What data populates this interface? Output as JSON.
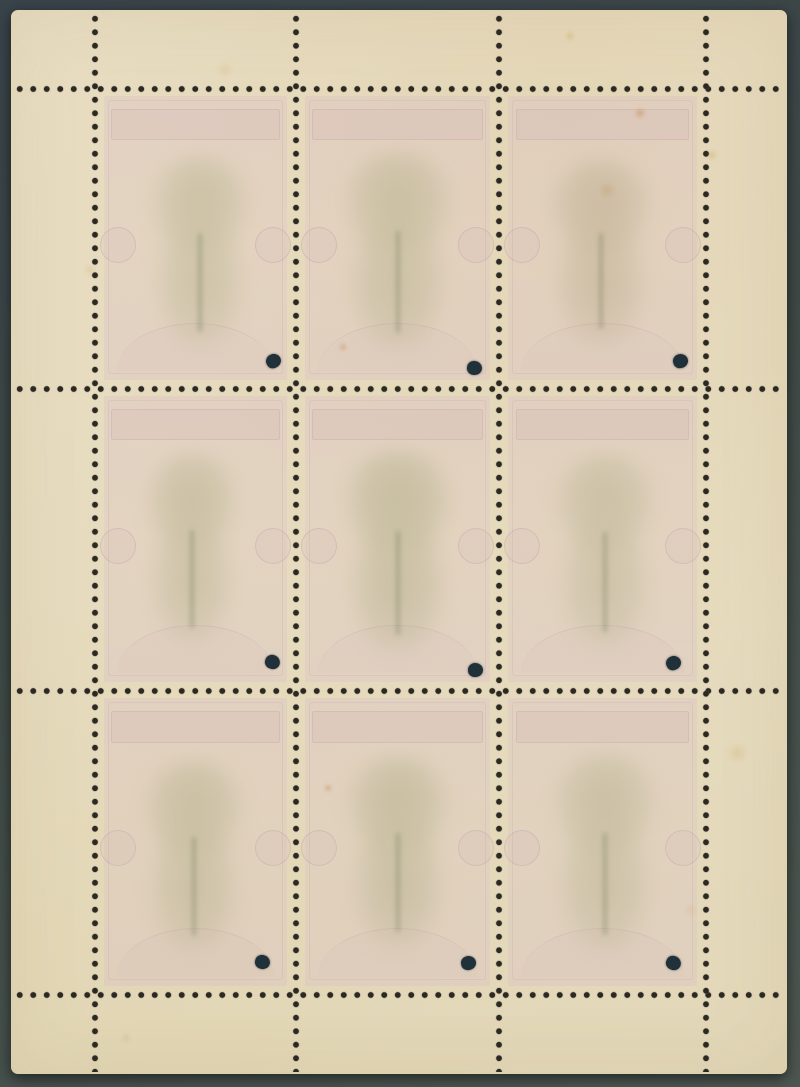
{
  "scene": {
    "description": "Photograph of the reverse (gum side) of a mint 3x3 stamp sheetlet with full perforation grid, one black punch hole per stamp, and faint show-through of a tree-design stamp printed in green and rose",
    "background": {
      "top_color": "#39434a",
      "bottom_color": "#4d5751"
    },
    "sheet": {
      "x": 11,
      "y": 10,
      "width": 776,
      "height": 1064,
      "paper_color": "#e7dcc0",
      "corner_radius": 7
    }
  },
  "perforations": {
    "dot_color": "#2b2922",
    "halo_color": "#6b6152",
    "dot_diameter": 6,
    "dot_spacing": 13.5,
    "h_lines_y": [
      79,
      379,
      681,
      985
    ],
    "v_lines_x": [
      84,
      285,
      488,
      695
    ]
  },
  "punch_hole": {
    "color": "#20313a",
    "diameter": 15
  },
  "stamp_design": {
    "pink_tint": "#d9bec6",
    "ornament_color": "#c29cae",
    "trunk_color": "#83886b"
  },
  "stamps": [
    {
      "x": 84,
      "y": 79,
      "w": 201,
      "h": 300,
      "dot": {
        "x": 178,
        "y": 272
      },
      "blob": {
        "top": 68,
        "h": 190,
        "w": 108,
        "dx": 4,
        "tint": "#b4b089",
        "opacity": 0.52
      }
    },
    {
      "x": 285,
      "y": 79,
      "w": 203,
      "h": 300,
      "dot": {
        "x": 178,
        "y": 279
      },
      "blob": {
        "top": 64,
        "h": 196,
        "w": 118,
        "dx": 0,
        "tint": "#b2ae88",
        "opacity": 0.55
      }
    },
    {
      "x": 488,
      "y": 79,
      "w": 207,
      "h": 300,
      "dot": {
        "x": 181,
        "y": 272
      },
      "blob": {
        "top": 70,
        "h": 185,
        "w": 112,
        "dx": -2,
        "tint": "#b3a584",
        "opacity": 0.5
      }
    },
    {
      "x": 84,
      "y": 379,
      "w": 201,
      "h": 302,
      "dot": {
        "x": 177,
        "y": 273
      },
      "blob": {
        "top": 66,
        "h": 188,
        "w": 100,
        "dx": -4,
        "tint": "#b1ad86",
        "opacity": 0.52
      }
    },
    {
      "x": 285,
      "y": 379,
      "w": 203,
      "h": 302,
      "dot": {
        "x": 179,
        "y": 281
      },
      "blob": {
        "top": 62,
        "h": 200,
        "w": 118,
        "dx": 0,
        "tint": "#aeab84",
        "opacity": 0.56
      }
    },
    {
      "x": 488,
      "y": 379,
      "w": 207,
      "h": 302,
      "dot": {
        "x": 174,
        "y": 274
      },
      "blob": {
        "top": 66,
        "h": 192,
        "w": 110,
        "dx": 2,
        "tint": "#b2ae88",
        "opacity": 0.5
      }
    },
    {
      "x": 84,
      "y": 681,
      "w": 201,
      "h": 304,
      "dot": {
        "x": 167,
        "y": 271
      },
      "blob": {
        "top": 70,
        "h": 190,
        "w": 108,
        "dx": -2,
        "tint": "#b0ac86",
        "opacity": 0.52
      }
    },
    {
      "x": 285,
      "y": 681,
      "w": 203,
      "h": 304,
      "dot": {
        "x": 172,
        "y": 272
      },
      "blob": {
        "top": 66,
        "h": 190,
        "w": 112,
        "dx": 0,
        "tint": "#afab85",
        "opacity": 0.54
      }
    },
    {
      "x": 488,
      "y": 681,
      "w": 207,
      "h": 304,
      "dot": {
        "x": 174,
        "y": 272
      },
      "blob": {
        "top": 64,
        "h": 196,
        "w": 114,
        "dx": 2,
        "tint": "#b1ad87",
        "opacity": 0.5
      }
    }
  ],
  "foxing_spots": [
    {
      "x": 629,
      "y": 103,
      "r": 6,
      "opacity": 0.45,
      "color": "#c07830"
    },
    {
      "x": 596,
      "y": 180,
      "r": 8,
      "opacity": 0.28,
      "color": "#c08a40"
    },
    {
      "x": 559,
      "y": 26,
      "r": 5,
      "opacity": 0.35,
      "color": "#c8922f"
    },
    {
      "x": 701,
      "y": 145,
      "r": 6,
      "opacity": 0.3,
      "color": "#c49038"
    },
    {
      "x": 332,
      "y": 337,
      "r": 4,
      "opacity": 0.45,
      "color": "#bd7226"
    },
    {
      "x": 317,
      "y": 778,
      "r": 4,
      "opacity": 0.5,
      "color": "#bd7226"
    },
    {
      "x": 726,
      "y": 743,
      "r": 11,
      "opacity": 0.22,
      "color": "#c89d4e"
    },
    {
      "x": 79,
      "y": 260,
      "r": 6,
      "opacity": 0.18,
      "color": "#b98c45"
    },
    {
      "x": 115,
      "y": 1028,
      "r": 5,
      "opacity": 0.22,
      "color": "#b98c45"
    },
    {
      "x": 214,
      "y": 60,
      "r": 9,
      "opacity": 0.14,
      "color": "#b98c45"
    },
    {
      "x": 680,
      "y": 900,
      "r": 7,
      "opacity": 0.18,
      "color": "#c89d4e"
    }
  ]
}
